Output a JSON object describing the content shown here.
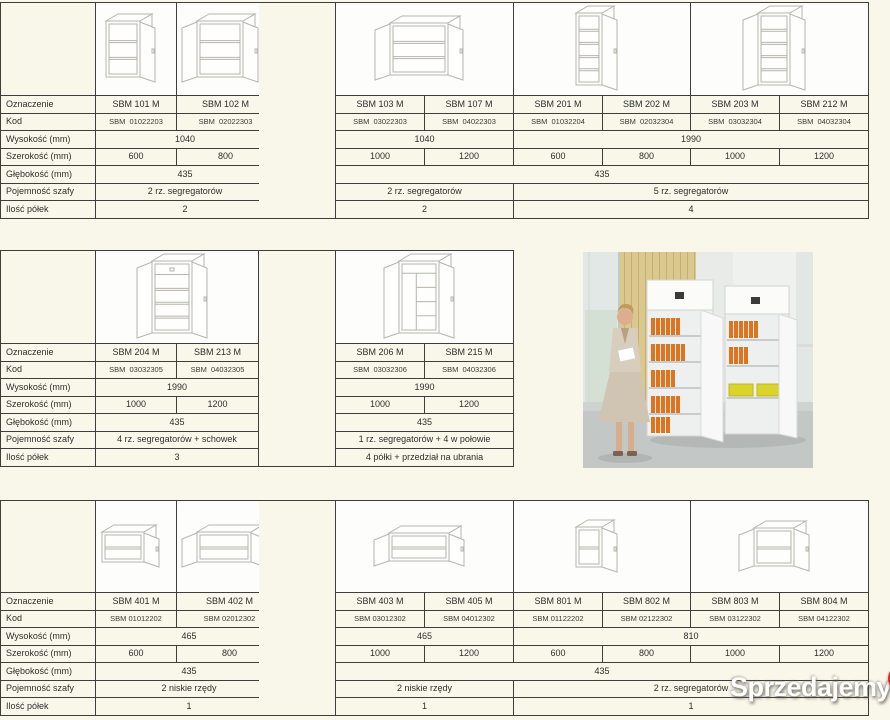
{
  "page": {
    "background": "#f8f7e9",
    "border_color": "#3e3e3e",
    "watermark": {
      "text": "Sprzedajemy",
      "suffix": ".pl",
      "badge_color": "#e5271b"
    }
  },
  "spec": {
    "row_labels": [
      "Oznaczenie",
      "Kod",
      "Wysokość (mm)",
      "Szerokość (mm)",
      "Głębokość (mm)",
      "Pojemność szafy",
      "Ilość półek"
    ]
  },
  "tables": {
    "top_left": {
      "drawings": [
        {
          "span": 1,
          "icon": "cabinet-1door-2shelf"
        },
        {
          "span": 1,
          "icon": "cabinet-2door-2shelf"
        }
      ],
      "rows": [
        [
          [
            "SBM 101 M",
            1
          ],
          [
            "SBM 102 M",
            1
          ]
        ],
        [
          [
            "SBM  01022203",
            1
          ],
          [
            "SBM  02022303",
            1
          ]
        ],
        [
          [
            "1040",
            2
          ]
        ],
        [
          [
            "600",
            1
          ],
          [
            "800",
            1
          ]
        ],
        [
          [
            "435",
            2
          ]
        ],
        [
          [
            "2 rz. segregatorów",
            2
          ]
        ],
        [
          [
            "2",
            2
          ]
        ]
      ]
    },
    "top_right": {
      "drawings": [
        {
          "span": 2,
          "icon": "cabinet-2door-2shelf-wide"
        },
        {
          "span": 2,
          "icon": "cabinet-1door-5shelf-tall"
        },
        {
          "span": 2,
          "icon": "cabinet-2door-5shelf-tall"
        }
      ],
      "rows": [
        [
          [
            "SBM 103 M",
            1
          ],
          [
            "SBM 107 M",
            1
          ],
          [
            "SBM 201 M",
            1
          ],
          [
            "SBM 202 M",
            1
          ],
          [
            "SBM 203 M",
            1
          ],
          [
            "SBM 212 M",
            1
          ]
        ],
        [
          [
            "SBM  03022303",
            1
          ],
          [
            "SBM  04022303",
            1
          ],
          [
            "SBM  01032204",
            1
          ],
          [
            "SBM  02032304",
            1
          ],
          [
            "SBM  03032304",
            1
          ],
          [
            "SBM  04032304",
            1
          ]
        ],
        [
          [
            "1040",
            2
          ],
          [
            "1990",
            4
          ]
        ],
        [
          [
            "1000",
            1
          ],
          [
            "1200",
            1
          ],
          [
            "600",
            1
          ],
          [
            "800",
            1
          ],
          [
            "1000",
            1
          ],
          [
            "1200",
            1
          ]
        ],
        [
          [
            "435",
            6
          ]
        ],
        [
          [
            "2 rz. segregatorów",
            2
          ],
          [
            "5 rz. segregatorów",
            4
          ]
        ],
        [
          [
            "2",
            2
          ],
          [
            "4",
            4
          ]
        ]
      ]
    },
    "mid_left": {
      "drawings": [
        {
          "span": 2,
          "icon": "cabinet-tall-storage-top"
        }
      ],
      "rows": [
        [
          [
            "SBM 204 M",
            1
          ],
          [
            "SBM 213 M",
            1
          ]
        ],
        [
          [
            "SBM  03032305",
            1
          ],
          [
            "SBM  04032305",
            1
          ]
        ],
        [
          [
            "1990",
            2
          ]
        ],
        [
          [
            "1000",
            1
          ],
          [
            "1200",
            1
          ]
        ],
        [
          [
            "435",
            2
          ]
        ],
        [
          [
            "4 rz. segregatorów + schowek",
            2
          ]
        ],
        [
          [
            "3",
            2
          ]
        ]
      ]
    },
    "mid_right": {
      "drawings": [
        {
          "span": 2,
          "icon": "cabinet-tall-wardrobe"
        }
      ],
      "rows": [
        [
          [
            "SBM 206 M",
            1
          ],
          [
            "SBM 215 M",
            1
          ]
        ],
        [
          [
            "SBM  03032306",
            1
          ],
          [
            "SBM  04032306",
            1
          ]
        ],
        [
          [
            "1990",
            2
          ]
        ],
        [
          [
            "1000",
            1
          ],
          [
            "1200",
            1
          ]
        ],
        [
          [
            "435",
            2
          ]
        ],
        [
          [
            "1 rz. segregatorów + 4 w połowie",
            2
          ]
        ],
        [
          [
            "4 półki + przedział na ubrania",
            2
          ]
        ]
      ]
    },
    "bottom_left": {
      "drawings": [
        {
          "span": 1,
          "icon": "cabinet-1door-1shelf-low"
        },
        {
          "span": 1,
          "icon": "cabinet-2door-1shelf-low"
        }
      ],
      "rows": [
        [
          [
            "SBM 401 M",
            1
          ],
          [
            "SBM 402 M",
            1
          ]
        ],
        [
          [
            "SBM 01012202",
            1
          ],
          [
            "SBM 02012302",
            1
          ]
        ],
        [
          [
            "465",
            2
          ]
        ],
        [
          [
            "600",
            1
          ],
          [
            "800",
            1
          ]
        ],
        [
          [
            "435",
            2
          ]
        ],
        [
          [
            "2 niskie rzędy",
            2
          ]
        ],
        [
          [
            "1",
            2
          ]
        ]
      ]
    },
    "bottom_right": {
      "drawings": [
        {
          "span": 2,
          "icon": "cabinet-2door-1shelf-low-wide"
        },
        {
          "span": 2,
          "icon": "cabinet-1door-2row-small"
        },
        {
          "span": 2,
          "icon": "cabinet-2door-2row-small"
        }
      ],
      "rows": [
        [
          [
            "SBM 403 M",
            1
          ],
          [
            "SBM 405 M",
            1
          ],
          [
            "SBM 801 M",
            1
          ],
          [
            "SBM 802 M",
            1
          ],
          [
            "SBM 803 M",
            1
          ],
          [
            "SBM 804 M",
            1
          ]
        ],
        [
          [
            "SBM 03012302",
            1
          ],
          [
            "SBM 04012302",
            1
          ],
          [
            "SBM 01122202",
            1
          ],
          [
            "SBM 02122302",
            1
          ],
          [
            "SBM 03122302",
            1
          ],
          [
            "SBM 04122302",
            1
          ]
        ],
        [
          [
            "465",
            2
          ],
          [
            "810",
            4
          ]
        ],
        [
          [
            "1000",
            1
          ],
          [
            "1200",
            1
          ],
          [
            "600",
            1
          ],
          [
            "800",
            1
          ],
          [
            "1000",
            1
          ],
          [
            "1200",
            1
          ]
        ],
        [
          [
            "435",
            6
          ]
        ],
        [
          [
            "2 niskie rzędy",
            2
          ],
          [
            "2 rz. segregatorów",
            4
          ]
        ],
        [
          [
            "1",
            2
          ],
          [
            "1",
            4
          ]
        ]
      ]
    }
  }
}
